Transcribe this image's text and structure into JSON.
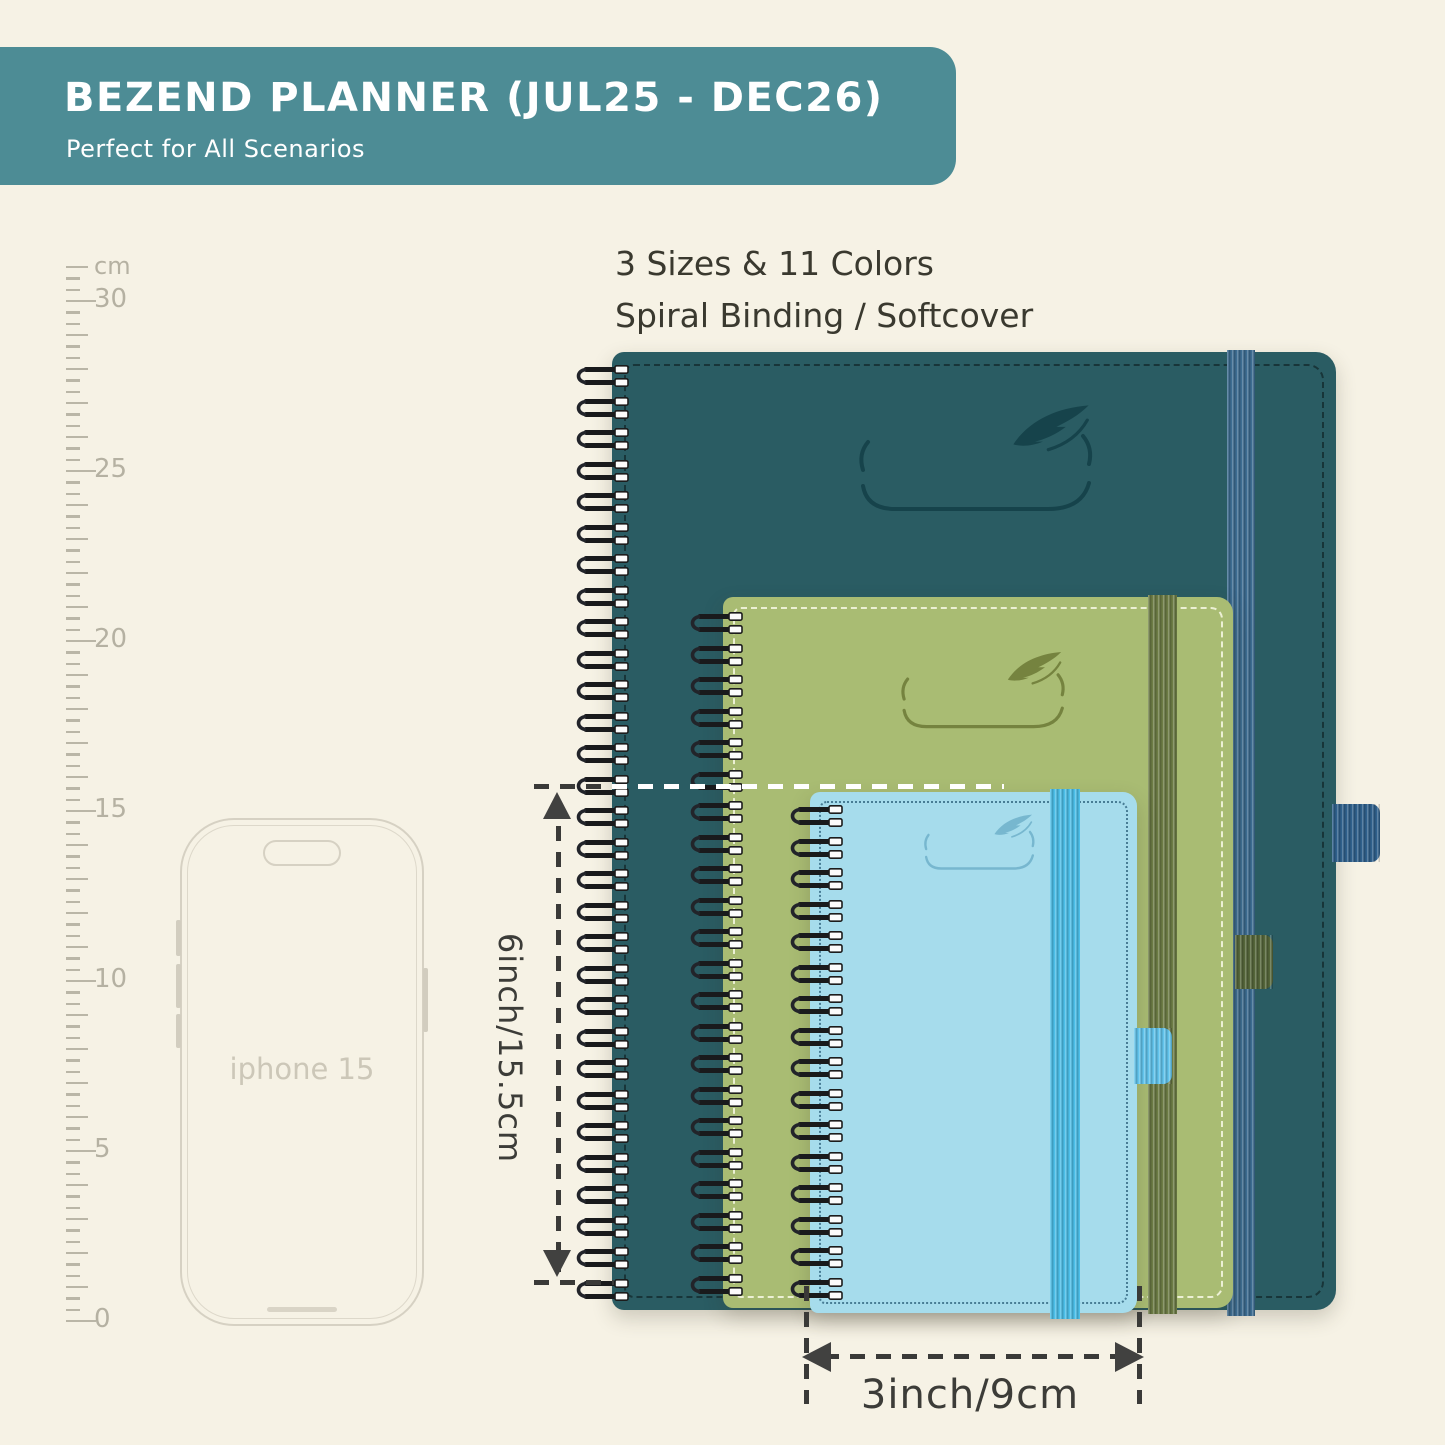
{
  "banner": {
    "title": "BEZEND PLANNER (JUL25 - DEC26)",
    "subtitle": "Perfect for All Scenarios",
    "bg_color": "#4d8c95"
  },
  "features": {
    "line1": "3 Sizes & 11 Colors",
    "line2": "Spiral Binding / Softcover"
  },
  "ruler": {
    "unit": "cm",
    "labels": [
      "30",
      "25",
      "20",
      "15",
      "10",
      "5",
      "0"
    ]
  },
  "phone": {
    "label": "iphone 15"
  },
  "planners": [
    {
      "size": "large",
      "label": "2025-26",
      "cover_color": "#2a5c63",
      "band_color": "#3d6d92",
      "logo_color": "#16434b"
    },
    {
      "size": "medium",
      "label": "2025-26",
      "cover_color": "#a9bc73",
      "band_color": "#6d7c45",
      "logo_color": "#75833f"
    },
    {
      "size": "small",
      "label": "2025-26",
      "cover_color": "#a6dcec",
      "band_color": "#4cbfe9",
      "logo_color": "#77b7cf"
    }
  ],
  "dimensions": {
    "height_label": "6inch/15.5cm",
    "width_label": "3inch/9cm"
  },
  "background_color": "#f6f2e5"
}
